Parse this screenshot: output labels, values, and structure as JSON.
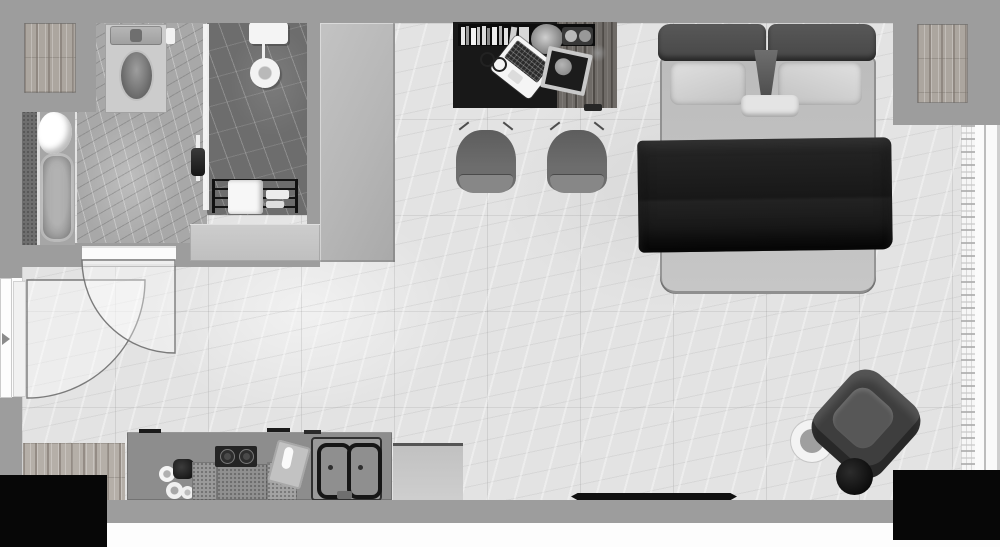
{
  "meta": {
    "title": "Studio apartment floor plan",
    "view": "top-down",
    "style": "grayscale 3D render",
    "canvas": {
      "width": 1000,
      "height": 547
    }
  },
  "palette": {
    "wall": "#9d9d9d",
    "floor": "#e3e3e3",
    "bathroom_floor": "#a8a8a8",
    "shower_floor": "#6d6d6d",
    "wood_panel": "#aca69f",
    "desk_wood": "#6f6b67",
    "desk_mat": "#181818",
    "counter": "#8d8d8d",
    "wardrobe": "#b8b8b8",
    "headboard": "#4d4d4d",
    "mattress": "#c3c3c3",
    "pillow": "#d8d8d8",
    "blanket": "#1b1b1b",
    "chair": "#6c6c6c",
    "armchair": "#3e3e3e",
    "ottoman": "#0a0a0a",
    "door_leaf": "#ffffff",
    "swing_arc_stroke": "#6e6e6e",
    "void_corner": "#070707"
  },
  "rooms": [
    {
      "name": "bathroom"
    },
    {
      "name": "shower"
    },
    {
      "name": "entry-hall"
    },
    {
      "name": "kitchenette"
    },
    {
      "name": "living-sleeping-area"
    }
  ],
  "labels": {
    "floor": "Marble tile floor",
    "bathroom_floor": "Bathroom floor",
    "shower": "Walk-in shower",
    "shower_head": "Rain shower head",
    "shower_controls": "Shower controls",
    "hand_shower": "Hand shower",
    "glass": "Shower glass panel",
    "towel_rack": "Towel rack",
    "towel": "Towel",
    "vanity": "Vanity counter",
    "toilet": "Toilet",
    "bathtub": "Bathtub",
    "plant_tub": "Plant",
    "wood_inset_left": "Wood panel",
    "wood_inset_right": "Wood panel",
    "wardrobe": "Wardrobe",
    "entry_door": "Entry door",
    "bathroom_door": "Bathroom door",
    "door_swing": "Door swing arcs",
    "wood_mat": "Wood floor mat",
    "counter": "Kitchen counter",
    "coffee_set": "Coffee set",
    "stove": "Two-burner cooktop",
    "baskets": "Counter trays",
    "cutting_board": "Cutting board",
    "sink": "Double sink",
    "faucet": "Faucet",
    "fridge": "Cabinet / mini fridge",
    "doormat": "Doormat",
    "desk": "Work desk",
    "desk_mat": "Desk mat",
    "books": "Book row",
    "desk_plant": "Plant",
    "tray": "Tray with plates",
    "laptop": "Laptop",
    "glasses": "Glasses",
    "photo_frame": "Frame with disc",
    "desk_deco": "Decor leaf",
    "drawer_tab": "Drawer handle",
    "chair_left": "Desk chair",
    "chair_right": "Desk chair",
    "bed": "Double bed",
    "headboard": "Headboard",
    "pillow_left": "Pillow",
    "pillow_right": "Pillow",
    "small_pillow": "Accent pillow",
    "throw_wedge": "Throw runner",
    "blanket": "Dark blanket",
    "armchair": "Lounge armchair",
    "ottoman": "Ottoman",
    "side_table": "Side table",
    "curtain": "Sheer curtain",
    "window": "Window sill",
    "wall": "Wall",
    "void": "Void / outside"
  }
}
